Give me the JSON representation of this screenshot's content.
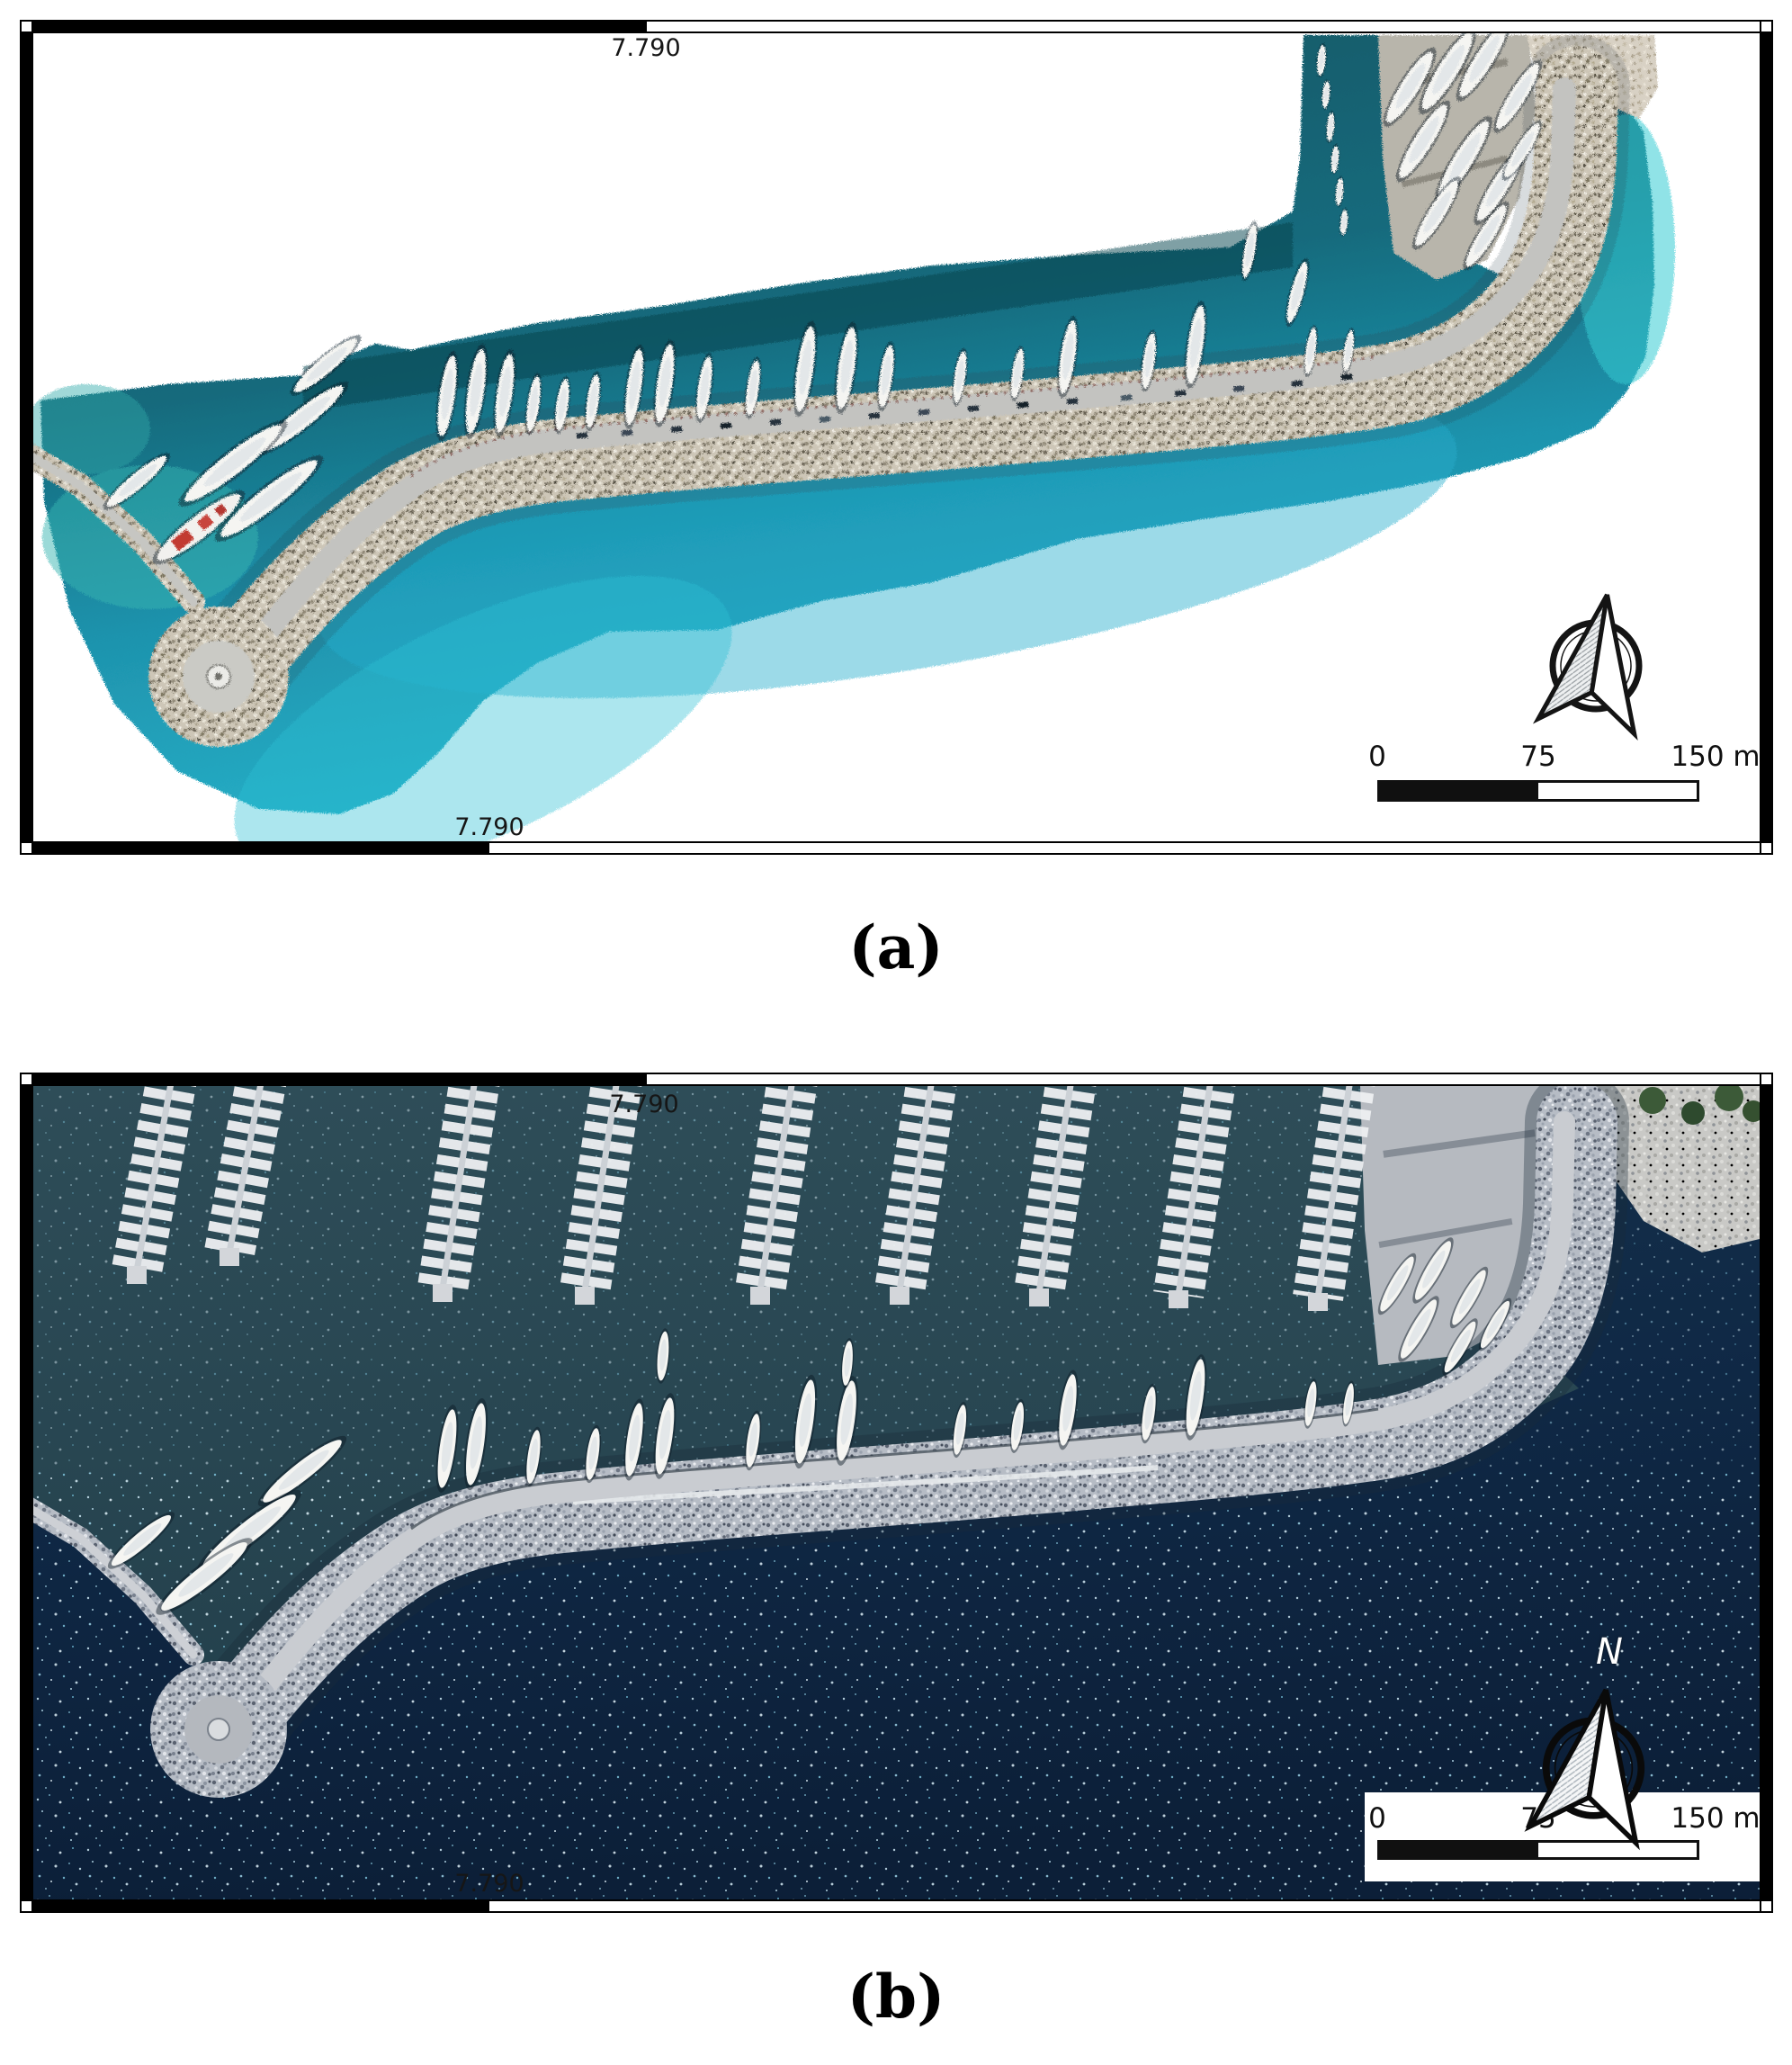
{
  "panel_a": {
    "caption": "(a)",
    "grid_top": "7.790",
    "grid_bottom": "7.790",
    "scalebar": {
      "t0": "0",
      "t1": "75",
      "t2": "150 m"
    }
  },
  "panel_b": {
    "caption": "(b)",
    "grid_top": "7.790",
    "grid_bottom": "7.790",
    "north": "N",
    "scalebar": {
      "t0": "0",
      "t1": "75",
      "t2": "150 m"
    }
  },
  "colors": {
    "frame-black": "#000000",
    "sea-teal-dark": "#11525e",
    "sea-teal-mid": "#156a7c",
    "sea-turquoise": "#1e93ad",
    "sea-cyan": "#27b0c8",
    "sea-deep": "#0c1f38",
    "sea-navy": "#0f2845",
    "basin-top": "#2e4d58",
    "basin-bottom": "#23404c",
    "rubble-a": "#cdc6b7",
    "rubble-b": "#b6bcc5",
    "road-a": "#c3c3c0",
    "road-b": "#c9ccd1",
    "sand": "#d8d1c4",
    "boat-white": "#f5f5f2"
  }
}
